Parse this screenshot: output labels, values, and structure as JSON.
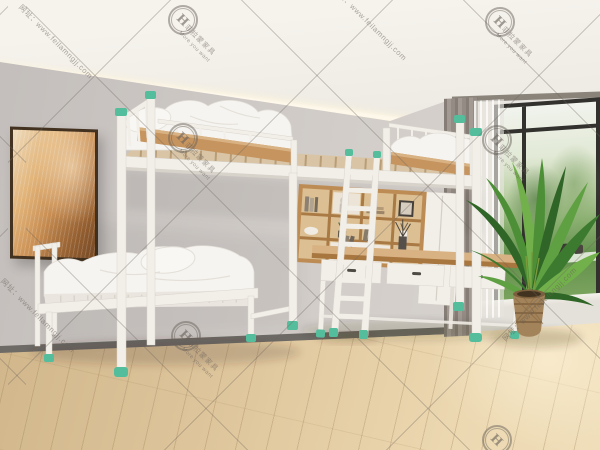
{
  "watermark": {
    "logo_glyph": "H",
    "brand_text": "菲拉蒙家具",
    "tagline_text": "More you want",
    "url_text": "网址：www.feilamngjj.com"
  },
  "palette": {
    "ceiling": "#f3f0ea",
    "glow": "#ffedc0",
    "wall": "#ccc7c3",
    "wall_window": "#e9e6e1",
    "baseboard": "#6e6a65",
    "floor_a": "#e9d6ae",
    "floor_b": "#cfb289",
    "white_frame": "#f2efe9",
    "frame_shadow": "#d7d2ca",
    "wood": "#c6945f",
    "wood_light": "#d9b283",
    "wood_dark": "#a8763f",
    "green": "#54bd9c",
    "bedding": "#f6f4f0",
    "curtain": "#968d85",
    "win_frame": "#33312e",
    "leaf_dark": "#2f6526",
    "leaf_mid": "#4c8f36",
    "leaf_light": "#72b04c",
    "basket": "#a3835a",
    "wm": "#6b645c"
  }
}
